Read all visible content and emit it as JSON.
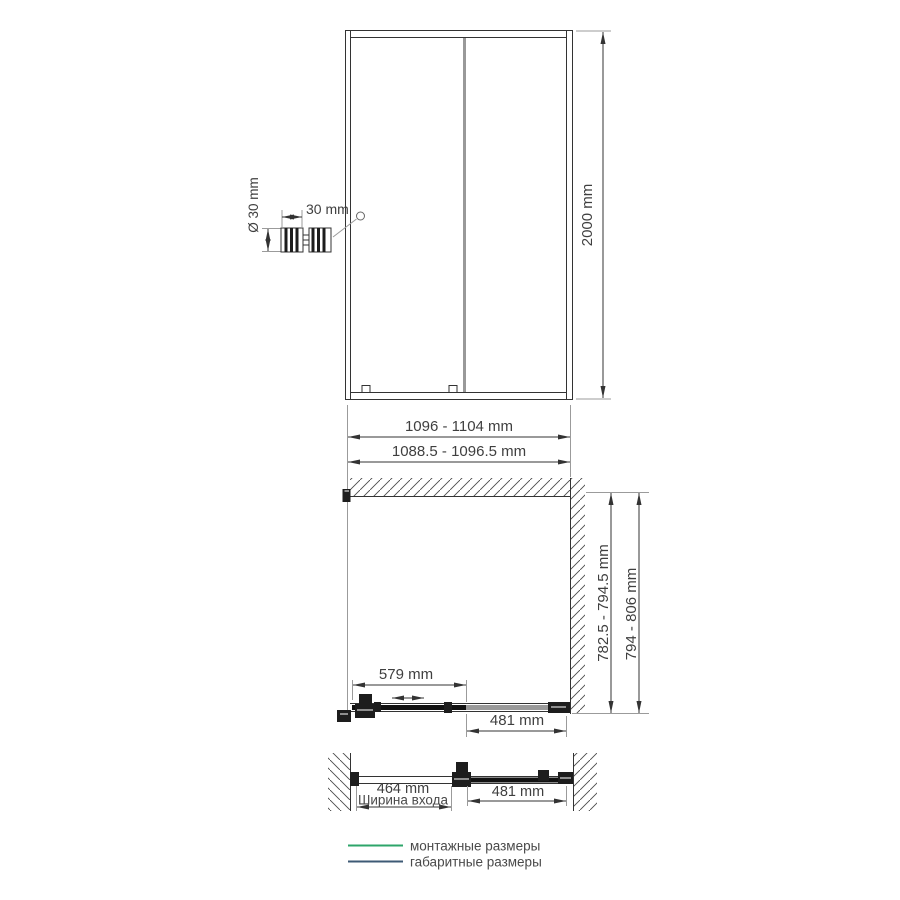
{
  "drawing": {
    "front_view": {
      "height_label": "2000 mm",
      "handle_detail": {
        "diameter_label": "Ø 30 mm",
        "length_label": "30 mm"
      }
    },
    "width_dimensions": {
      "overall": "1096 - 1104 mm",
      "mounting": "1088.5 - 1096.5 mm"
    },
    "plan_view": {
      "sliding_panel": "579 mm",
      "fixed_panel": "481 mm",
      "depth_mounting": "782.5 - 794.5 mm",
      "depth_overall": "794 - 806 mm"
    },
    "open_view": {
      "entry_width": "464 mm",
      "entry_caption": "Ширина входа",
      "door_panel": "481 mm"
    },
    "legend": {
      "mounting_label": "монтажные размеры",
      "overall_label": "габаритные размеры"
    },
    "colors": {
      "mounting_green": "#2ea56a",
      "overall_blue": "#3e5a75"
    }
  }
}
